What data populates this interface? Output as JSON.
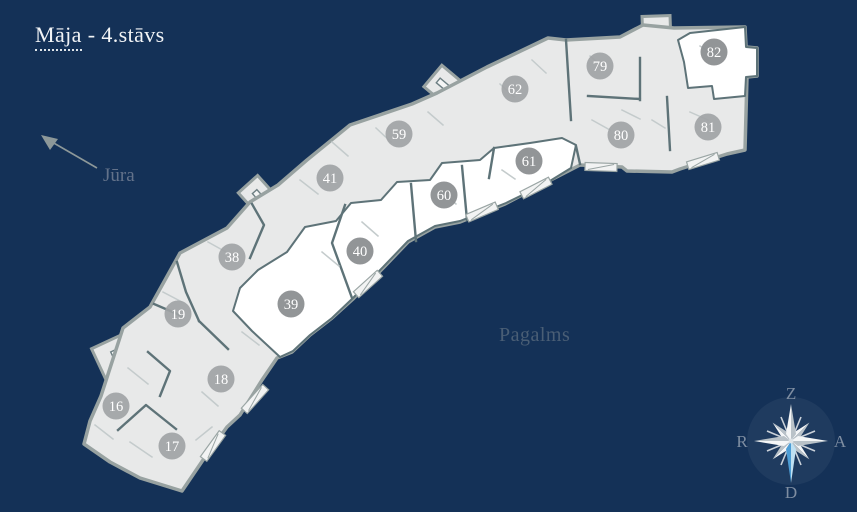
{
  "title": {
    "building_link": "Māja",
    "floor_suffix": " - 4.stāvs"
  },
  "map_labels": {
    "sea": "Jūra",
    "courtyard": "Pagalms"
  },
  "compass": {
    "north": "Z",
    "east": "A",
    "south": "D",
    "west": "R"
  },
  "apartments": [
    {
      "number": "16",
      "x": 116,
      "y": 406,
      "highlighted": false
    },
    {
      "number": "17",
      "x": 172,
      "y": 446,
      "highlighted": false
    },
    {
      "number": "18",
      "x": 221,
      "y": 379,
      "highlighted": false
    },
    {
      "number": "19",
      "x": 178,
      "y": 314,
      "highlighted": false
    },
    {
      "number": "38",
      "x": 232,
      "y": 257,
      "highlighted": false
    },
    {
      "number": "39",
      "x": 291,
      "y": 304,
      "highlighted": true
    },
    {
      "number": "40",
      "x": 360,
      "y": 251,
      "highlighted": true
    },
    {
      "number": "41",
      "x": 330,
      "y": 178,
      "highlighted": false
    },
    {
      "number": "59",
      "x": 399,
      "y": 134,
      "highlighted": false
    },
    {
      "number": "60",
      "x": 444,
      "y": 195,
      "highlighted": true
    },
    {
      "number": "61",
      "x": 529,
      "y": 161,
      "highlighted": true
    },
    {
      "number": "62",
      "x": 515,
      "y": 89,
      "highlighted": false
    },
    {
      "number": "79",
      "x": 600,
      "y": 66,
      "highlighted": false
    },
    {
      "number": "80",
      "x": 621,
      "y": 135,
      "highlighted": false
    },
    {
      "number": "81",
      "x": 708,
      "y": 127,
      "highlighted": false
    },
    {
      "number": "82",
      "x": 714,
      "y": 52,
      "highlighted": true
    }
  ],
  "colors": {
    "background": "#143157",
    "building_fill": "#e8e9e9",
    "highlight_fill": "#ffffff",
    "outline": "#98a2a1",
    "wall": "#5e7378",
    "marker": "#a0a3a5",
    "marker_highlighted": "#8c8f91",
    "marker_text": "#ffffff",
    "compass_blue": "#4d9dd4"
  }
}
